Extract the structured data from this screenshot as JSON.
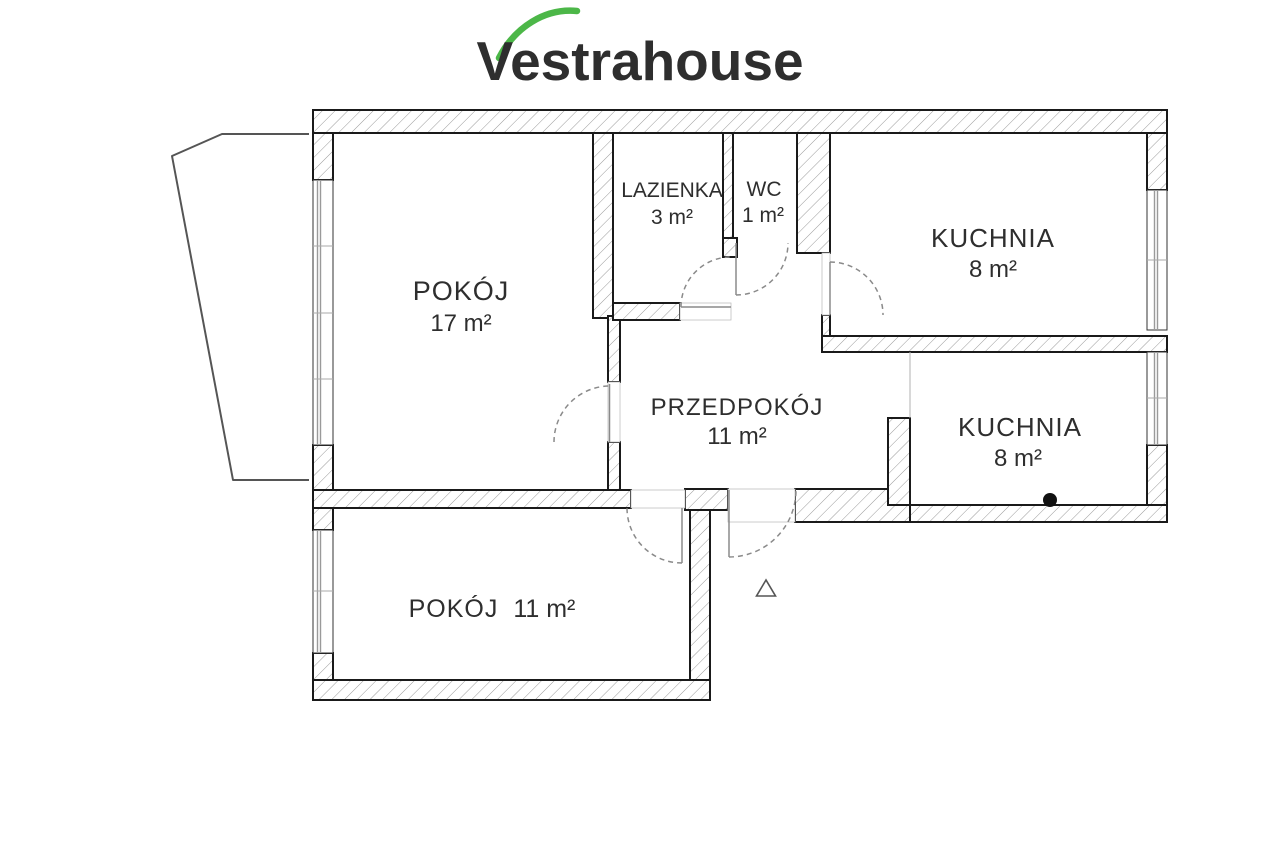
{
  "logo": {
    "text": "Vestrahouse"
  },
  "colors": {
    "logo_green": "#4cb748",
    "wall_line": "#1a1a1a",
    "hatch_line": "#9a9a9a",
    "door_line": "#8a8a8a"
  },
  "rooms": {
    "pokoj17": {
      "name": "POKÓJ",
      "area": "17 m²"
    },
    "lazienka": {
      "name": "LAZIENKA",
      "area": "3 m²"
    },
    "wc": {
      "name": "WC",
      "area": "1 m²"
    },
    "kuchnia_top": {
      "name": "KUCHNIA",
      "area": "8 m²"
    },
    "przedpokoj": {
      "name": "PRZEDPOKÓJ",
      "area": "11 m²"
    },
    "kuchnia_mid": {
      "name": "KUCHNIA",
      "area": "8 m²"
    },
    "pokoj11": {
      "name": "POKÓJ",
      "area": "11 m²"
    }
  }
}
